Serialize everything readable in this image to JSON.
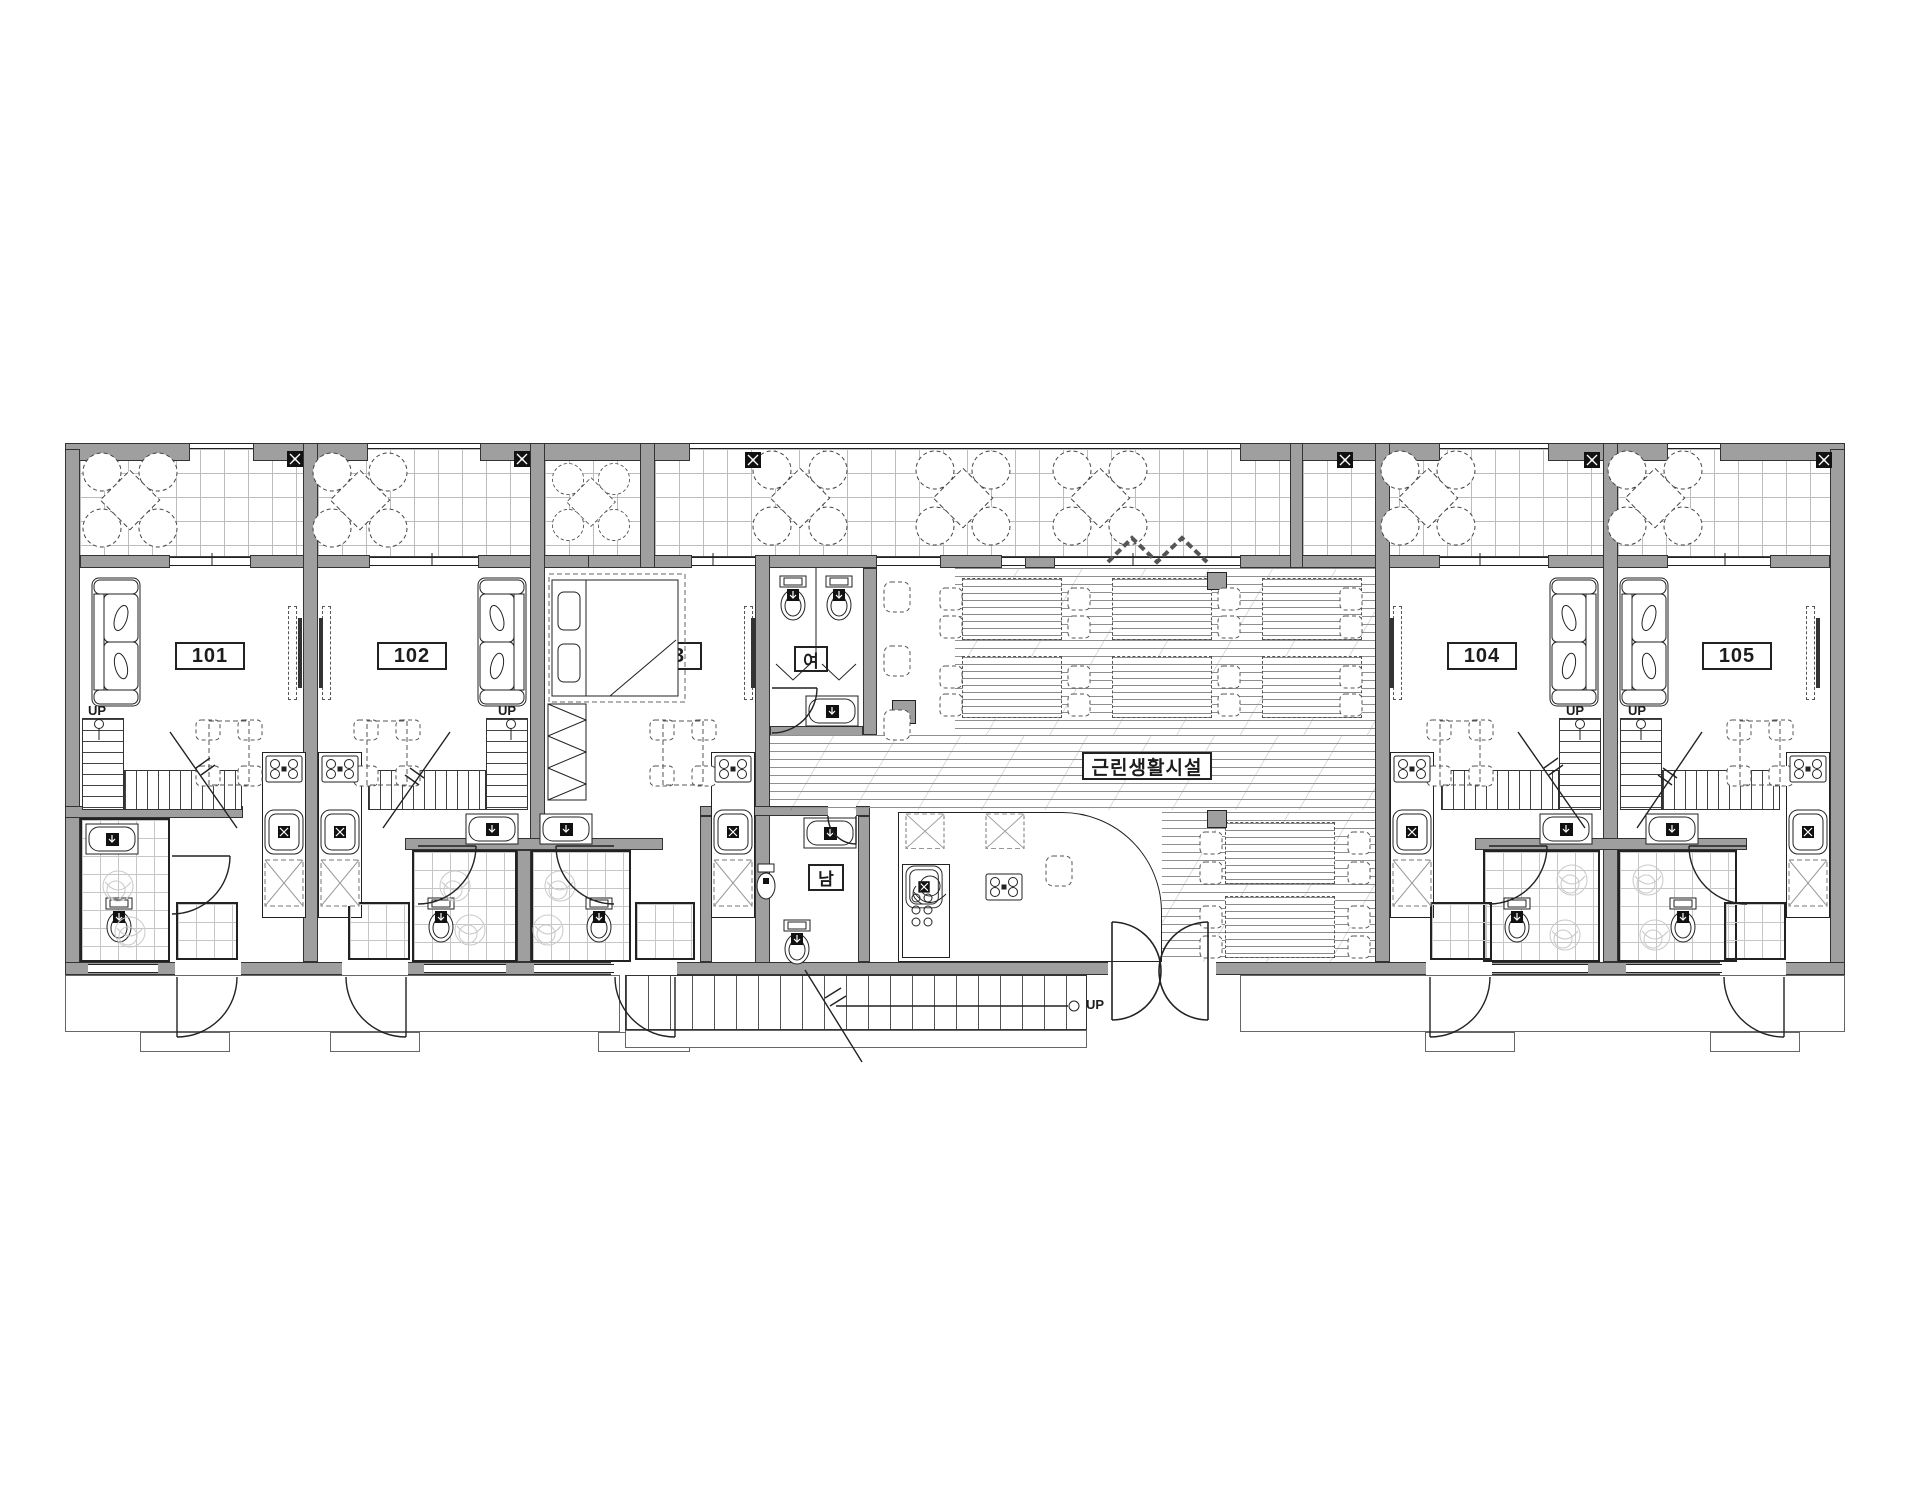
{
  "plan": {
    "type": "architectural-floor-plan",
    "units": [
      {
        "number": "101"
      },
      {
        "number": "102"
      },
      {
        "number": "103"
      },
      {
        "number": "104"
      },
      {
        "number": "105"
      }
    ],
    "commercial": {
      "label": "근린생활시설"
    },
    "restrooms": {
      "women": "여",
      "men": "남"
    },
    "stairs": {
      "up_label": "UP"
    },
    "colors": {
      "wall": "#9f9f9f",
      "line": "#222222",
      "grid": "#bdbdbd",
      "ghost_fixture": "#c9c9c9",
      "background": "#ffffff"
    }
  }
}
